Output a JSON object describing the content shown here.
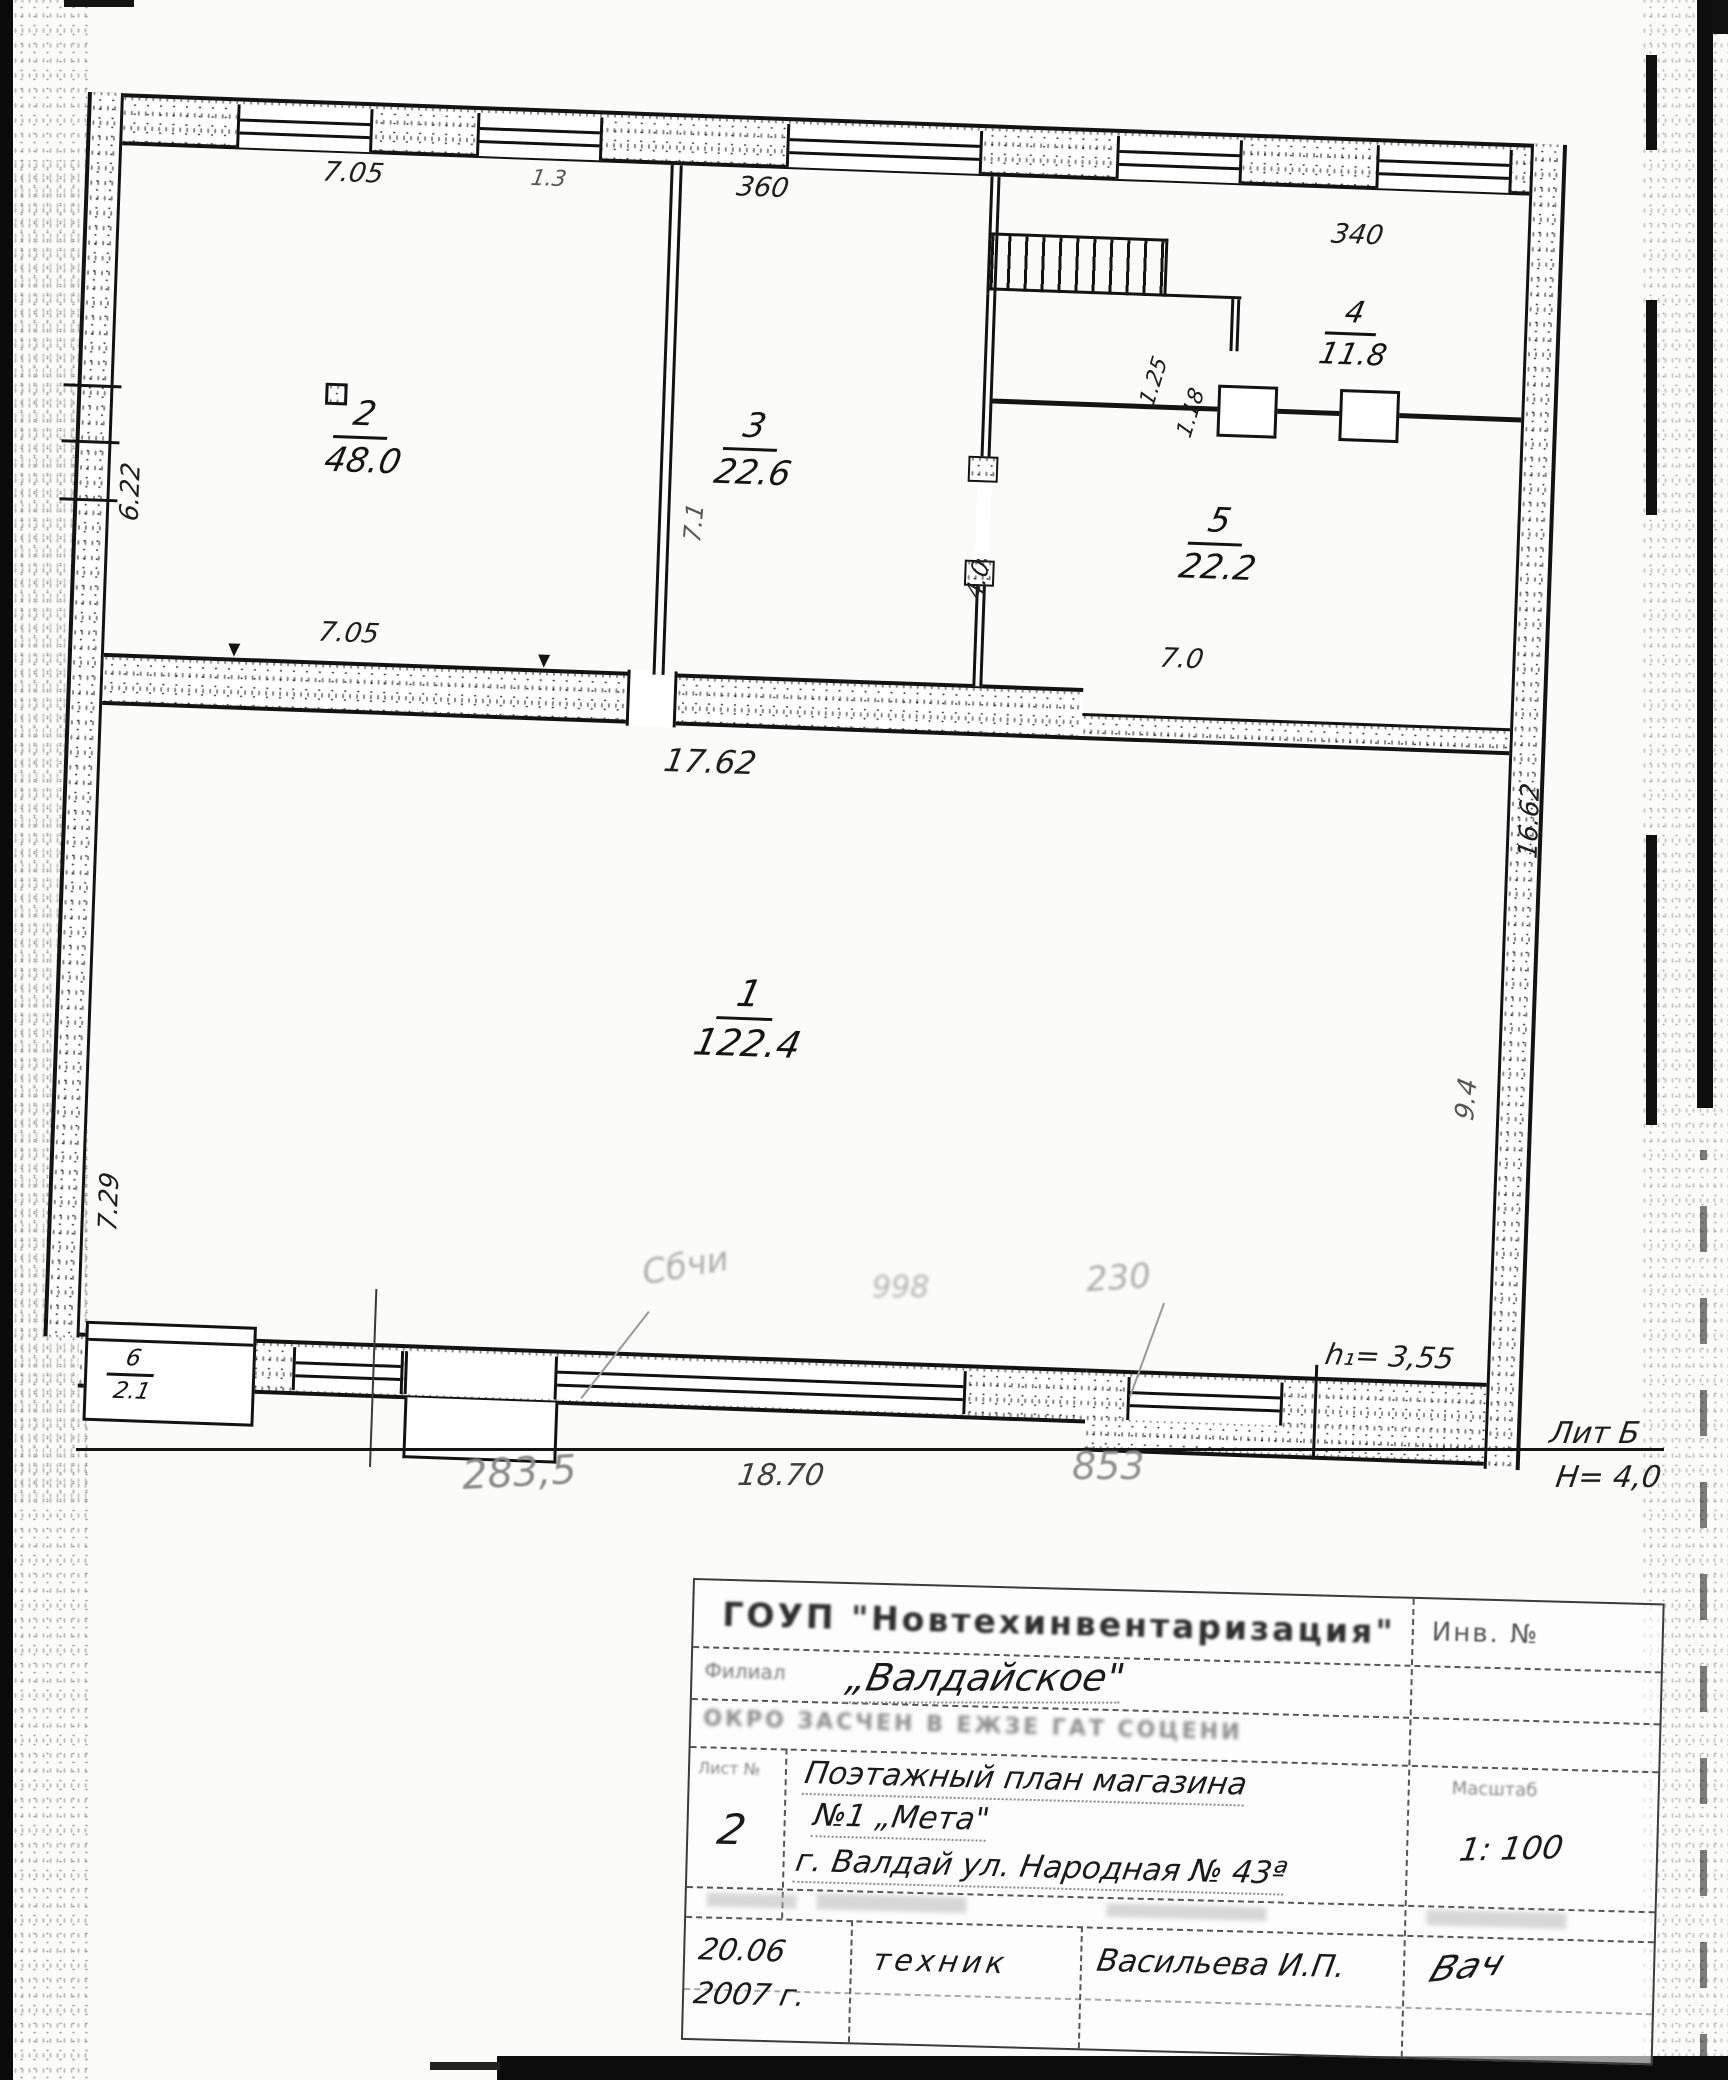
{
  "plan": {
    "rooms": [
      {
        "number": "2",
        "area": "48.0"
      },
      {
        "number": "3",
        "area": "22.6"
      },
      {
        "number": "4",
        "area": "11.8"
      },
      {
        "number": "5",
        "area": "22.2"
      },
      {
        "number": "1",
        "area": "122.4"
      },
      {
        "number": "6",
        "area": "2.1"
      }
    ],
    "dimensions": {
      "top_left": "7.05",
      "top_gap": "1.3",
      "top_mid": "360",
      "top_right": "340",
      "left_upper": "6.22",
      "left_lower": "7.29",
      "mid_left": "7.05",
      "mid_right": "7.0",
      "mid_total": "17.62",
      "right_outer": "16.62",
      "right_inner": "9.4",
      "stair_door_1": "1.25",
      "stair_door_2": "1.18",
      "wall23": "7.1",
      "door35": "4.0",
      "bottom_faint_left": "283,5",
      "bottom_center": "18.70",
      "bottom_faint_right": "853"
    },
    "notes": {
      "height_note": "h₁= 3,55",
      "liter": "Лит Б",
      "building_height": "Н= 4,0"
    },
    "ghost_marks": [
      "Сбчи",
      "998",
      "230"
    ]
  },
  "title_block": {
    "stamp_org": "ГОУП \"Новтехинвентаризация\"",
    "inv_label": "Инв. №",
    "branch_label": "Филиал",
    "branch_value": "„Валдайское\"",
    "stamp_line3": "ОКРО ЗАСЧЕН В ЕЖЗЕ ГАТ СОЦЕНИ",
    "sheet_label": "Лист №",
    "sheet_value": "2",
    "object_line1": "Поэтажный план магазина",
    "object_line2": "№1 „Мета\"",
    "object_line3": "г. Валдай ул. Народная № 43ª",
    "scale_label": "Масштаб",
    "scale_value": "1: 100",
    "date_line1": "20.06",
    "date_line2": "2007 г.",
    "role": "техник",
    "name": "Васильева И.П.",
    "signature": "Вач"
  }
}
